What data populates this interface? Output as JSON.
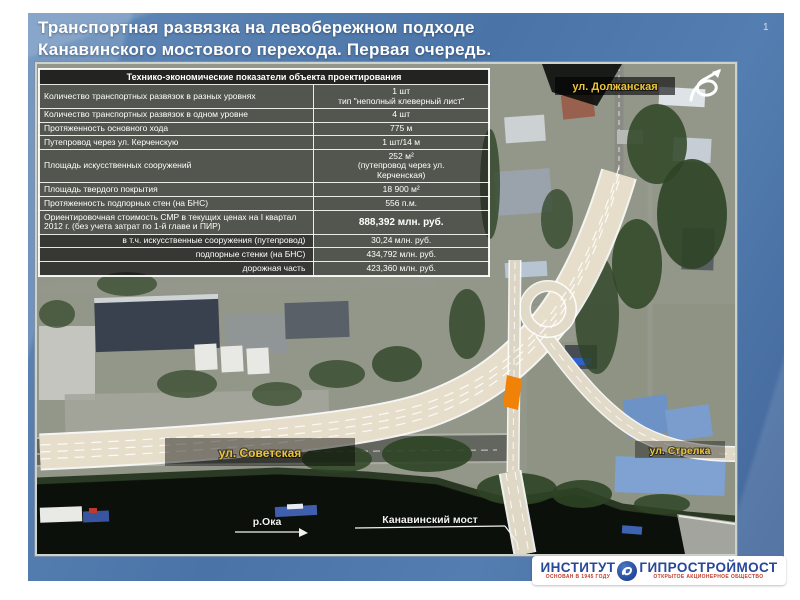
{
  "slide": {
    "page_number": "1",
    "title": [
      "Транспортная развязка на левобережном подходе",
      "Канавинского мостового перехода. Первая очередь."
    ]
  },
  "table": {
    "title": "Технико-экономические показатели объекта проектирования",
    "rows": [
      {
        "label": "Количество транспортных развязок в разных уровнях",
        "value": "1 шт",
        "value2": "тип \"неполный клеверный лист\""
      },
      {
        "label": "Количество транспортных развязок в одном уровне",
        "value": "4 шт"
      },
      {
        "label": "Протяженность основного хода",
        "value": "775 м"
      },
      {
        "label": "Путепровод через ул. Керченскую",
        "value": "1 шт/14 м"
      },
      {
        "label": "Площадь искусственных сооружений",
        "value": "252 м²",
        "value2": "(путепровод через ул.",
        "value3": "Керченская)"
      },
      {
        "label": "Площадь твердого покрытия",
        "value": "18 900 м²"
      },
      {
        "label": "Протяженность подпорных стен (на БНС)",
        "value": "556 п.м."
      },
      {
        "label": "Ориентировочная стоимость СМР в текущих ценах на I квартал 2012 г. (без учета затрат по 1-й главе и ПИР)",
        "value": "888,392 млн. руб."
      },
      {
        "label": "в т.ч. искусственные сооружения (путепровод)",
        "value": "30,24 млн. руб."
      },
      {
        "label": "подпорные стенки (на БНС)",
        "value": "434,792 млн. руб."
      },
      {
        "label": "дорожная часть",
        "value": "423,360 млн. руб."
      }
    ]
  },
  "map": {
    "street_dolzhanskaya": "ул. Должанская",
    "street_sovetskaya": "ул. Советская",
    "street_strelka": "ул. Стрелка",
    "river": "р.Ока",
    "bridge": "Канавинский мост"
  },
  "logo": {
    "word1": "ИНСТИТУТ",
    "word2": "ГИПРОСТРОЙМОСТ",
    "sub1": "ОСНОВАН В 1945 ГОДУ",
    "sub2": "ОТКРЫТОЕ АКЦИОНЕРНОЕ ОБЩЕСТВО"
  },
  "colors": {
    "slide_bg": "#4f79ae",
    "accent_yellow": "#ecc436",
    "highlight_orange": "#ef8207",
    "logo_blue": "#26479a",
    "logo_red": "#c23a2b"
  }
}
